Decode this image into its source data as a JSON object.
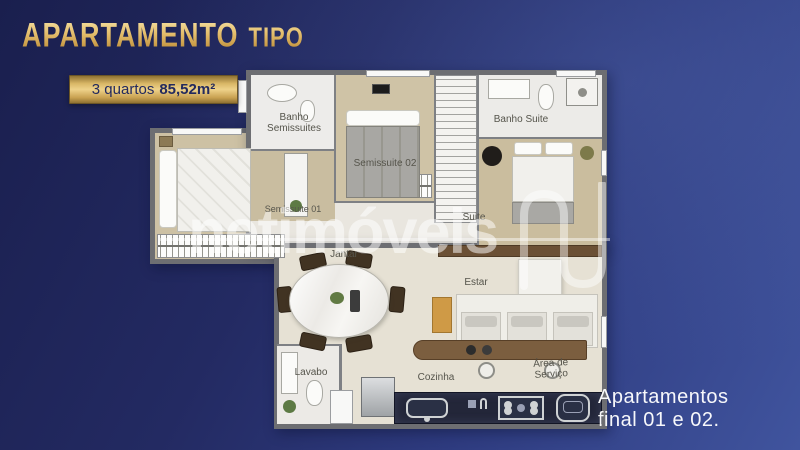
{
  "header": {
    "title_main": "APARTAMENTO",
    "title_sub": "TIPO"
  },
  "badge": {
    "quartos": "3 quartos",
    "area": "85,52m²"
  },
  "watermark": {
    "text": "netimóveis",
    "logo": "netimoveis-n-logo"
  },
  "footnote": {
    "line1": "Apartamentos",
    "line2": "final 01 e 02."
  },
  "floorplan": {
    "labels": {
      "banho_semissuites_1": "Banho",
      "banho_semissuites_2": "Semissuites",
      "semissuite_02": "Semissuite 02",
      "banho_suite": "Banho Suite",
      "suite": "Suite",
      "semissuite_01": "Semissuite 01",
      "jantar": "Jantar",
      "estar": "Estar",
      "lavabo": "Lavabo",
      "cozinha": "Cozinha",
      "area_servico_1": "Área de",
      "area_servico_2": "Serviço"
    }
  },
  "colors": {
    "background_navy": "#1a1f4e",
    "background_blue": "#40549e",
    "accent_gold": "#d9b766",
    "badge_text_navy": "#232a5e",
    "wall_gray": "#6d6e72",
    "wood_floor": "#cdc1a4",
    "tile_floor": "#e8e5de",
    "counter_dark": "#232639",
    "watermark_white": "rgba(255,255,255,0.5)"
  }
}
